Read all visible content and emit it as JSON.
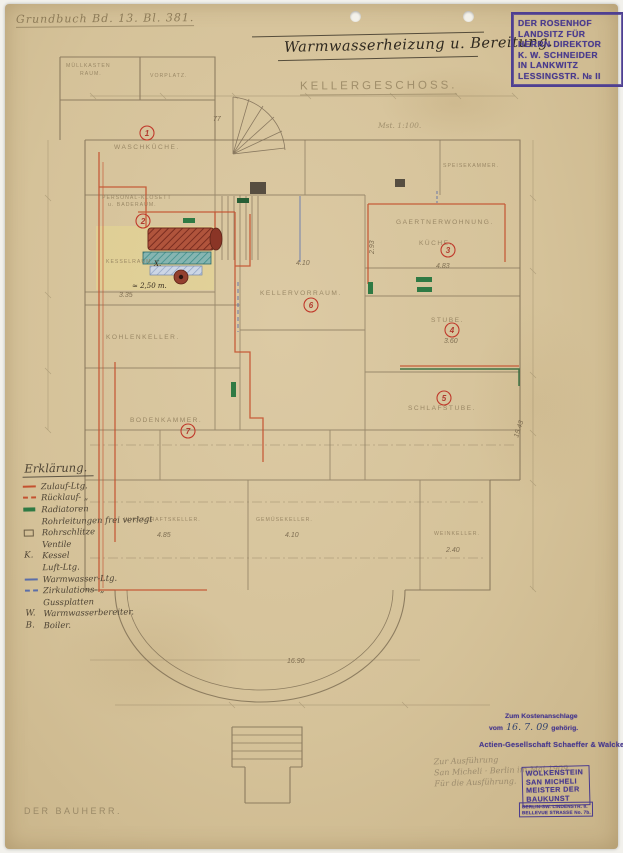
{
  "sheet": {
    "grundbuch": "Grundbuch Bd. 13. Bl. 381.",
    "title": "Warmwasserheizung u. Bereitung.",
    "floor_label": "KELLERGESCHOSS.",
    "scale_note": "Mst. 1:100.",
    "bauherr_label": "DER BAUHERR."
  },
  "owner_stamp": {
    "lines": [
      "DER ROSENHOF",
      "LANDSITZ FÜR",
      "HERRN DIREKTOR",
      "K. W. SCHNEIDER",
      "IN LANKWITZ",
      "LESSINGSTR. № II"
    ]
  },
  "plan": {
    "labels": [
      {
        "text": "MÜLLKASTEN"
      },
      {
        "text": "RAUM."
      },
      {
        "text": "VORPLATZ."
      },
      {
        "text": "SPEISEKAMMER."
      },
      {
        "text": "WASCHKÜCHE."
      },
      {
        "text": "PERSONAL-KLOSETT"
      },
      {
        "text": "u. BADERAUM."
      },
      {
        "text": "KESSELRAUM."
      },
      {
        "text": "KELLERVORRAUM."
      },
      {
        "text": "GAERTNERWOHNUNG."
      },
      {
        "text": "KÜCHE."
      },
      {
        "text": "STUBE."
      },
      {
        "text": "SCHLAFSTUBE."
      },
      {
        "text": "KOHLENKELLER."
      },
      {
        "text": "BODENKAMMER."
      },
      {
        "text": "WIRTSCHAFTSKELLER."
      },
      {
        "text": "GEMÜSEKELLER."
      },
      {
        "text": "WEINKELLER."
      }
    ],
    "dims": [
      {
        "text": "4.10"
      },
      {
        "text": "2.93"
      },
      {
        "text": "4.83"
      },
      {
        "text": "3.60"
      },
      {
        "text": "3.35"
      },
      {
        "text": "≈ 2,50 m."
      },
      {
        "text": "4.85"
      },
      {
        "text": "4.10"
      },
      {
        "text": "2.40"
      },
      {
        "text": "15.43"
      },
      {
        "text": "16.90"
      },
      {
        "text": "77"
      },
      {
        "text": "X."
      }
    ],
    "room_numbers": [
      "1",
      "2",
      "3",
      "4",
      "5",
      "6",
      "7"
    ]
  },
  "legend": {
    "title": "Erklärung.",
    "items": [
      {
        "prefix": "",
        "label": "Zulauf-Ltg."
      },
      {
        "prefix": "",
        "label": "Rücklauf-  „"
      },
      {
        "prefix": "",
        "label": "Radiatoren"
      },
      {
        "prefix": "",
        "label": "Rohrleitungen frei verlegt"
      },
      {
        "prefix": "",
        "label": "Rohrschlitze"
      },
      {
        "prefix": "",
        "label": "Ventile"
      },
      {
        "prefix": "K.",
        "label": "Kessel"
      },
      {
        "prefix": "",
        "label": "Luft-Ltg."
      },
      {
        "prefix": "",
        "label": "Warmwasser-Ltg."
      },
      {
        "prefix": "",
        "label": "Zirkulations-  „"
      },
      {
        "prefix": "",
        "label": "Gussplatten"
      },
      {
        "prefix": "W.",
        "label": "Warmwasserbereiter."
      },
      {
        "prefix": "B.",
        "label": "Boiler."
      }
    ]
  },
  "approval": {
    "cost_stamp": {
      "line1": "Zum Kostenanschlage",
      "word_vom": "vom",
      "date_handwritten": "16. 7. 09",
      "word_suffix": "gehörig."
    },
    "company_stamp": "Actien-Gesellschaft Schaeffer & Walcker",
    "pencil_notes": [
      "Zur Ausführung",
      "San Micheli · Berlin im Mai 1909.",
      "Für die Ausführung."
    ],
    "architect_stamp_lines": [
      "WOLKENSTEIN",
      "SAN MICHELI",
      "MEISTER DER",
      "BAUKUNST"
    ],
    "address_stamp_lines": [
      "BERLIN-SW. LINDENSTR. 8.",
      "BELLEVUE STRASSE No. 7b."
    ]
  },
  "colors": {
    "paper": "#d5c299",
    "pipe_supply_red": "#c4512f",
    "radiator_green": "#2f7a44",
    "water_line_blue": "#5b6ea8",
    "stamp_purple": "#4a3b8e",
    "pencil": "#8f7d5c",
    "ink": "#2e281f"
  }
}
